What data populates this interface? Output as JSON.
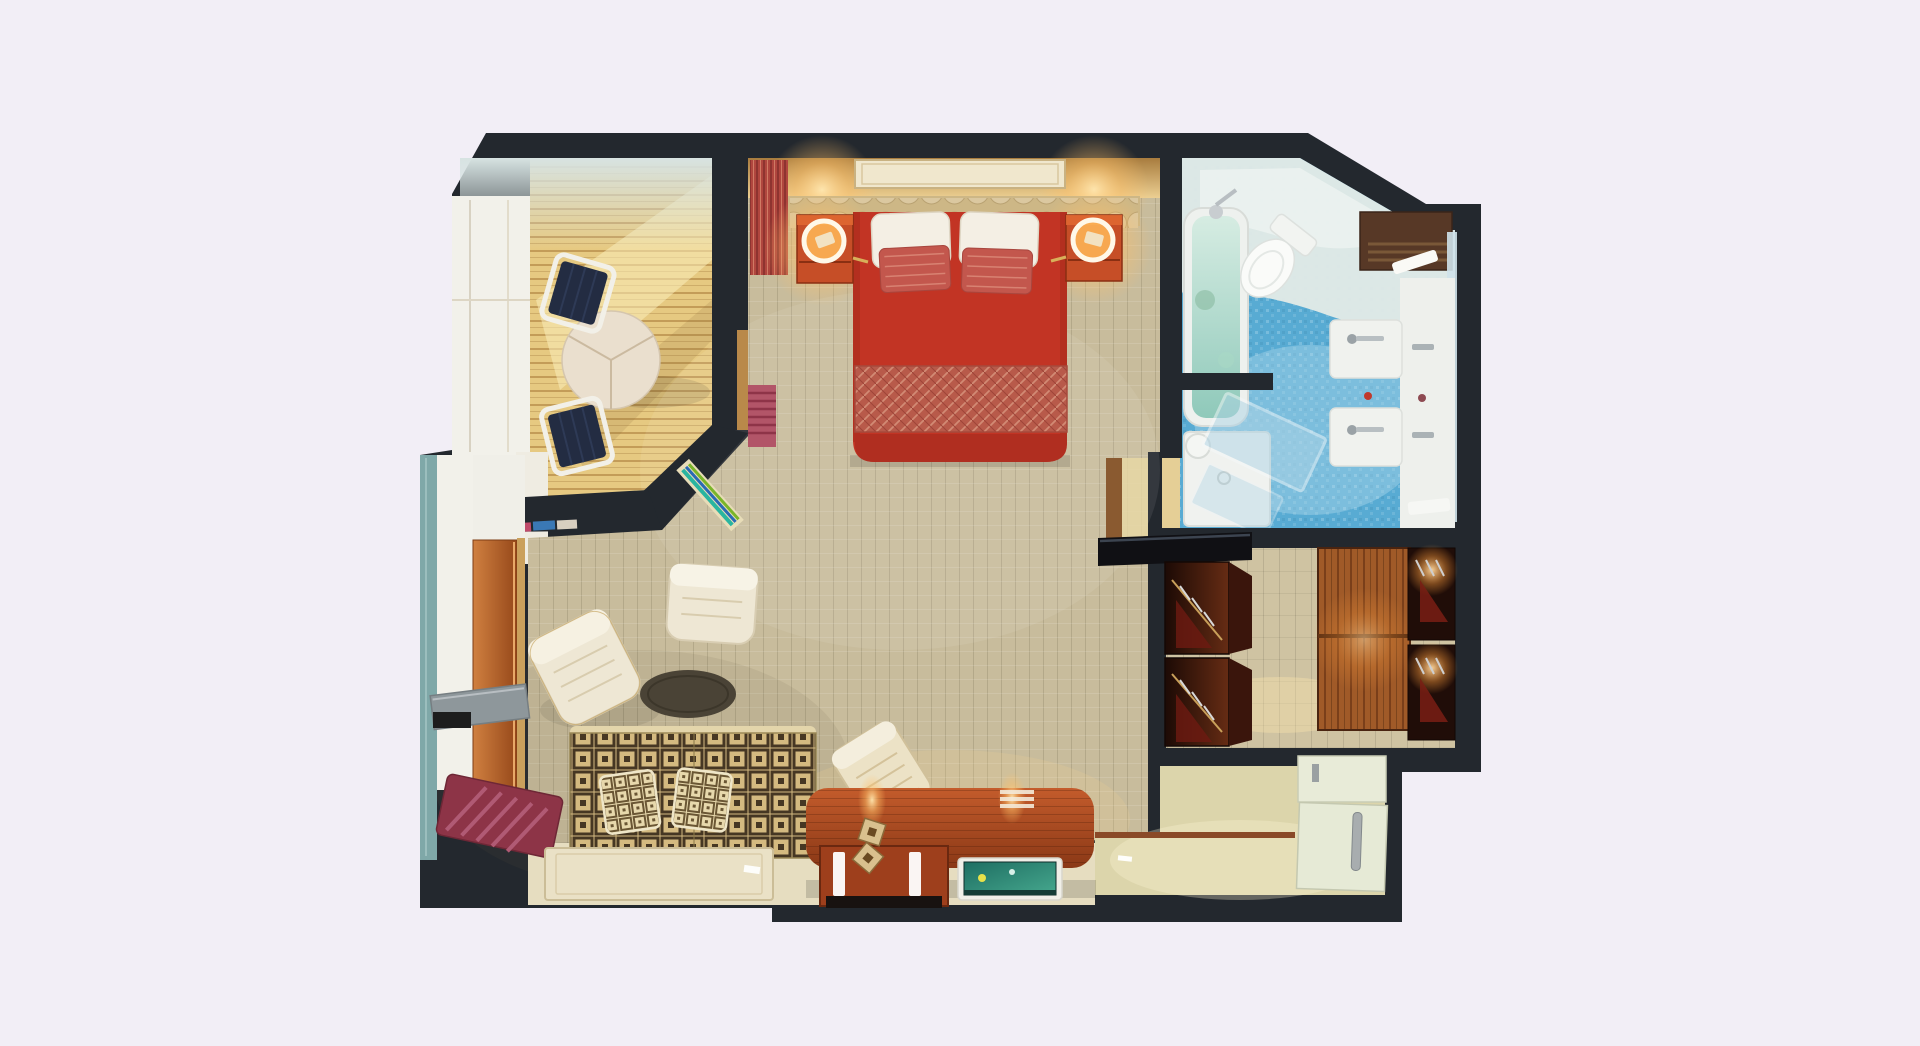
{
  "image_kind": "3d-floor-plan-render-top-down",
  "palette": {
    "background": "#f2eef6",
    "wall": "#23282e",
    "wallLight": "#f2f1ea",
    "carpet": "#c8bc9c",
    "woodFloor": "#e6c981",
    "paleFloor": "#e6ddc0",
    "entryFloor": "#dcd5ab",
    "closetFloor": "#cfc3a2",
    "bathFloorBlue": "#58abd3",
    "mintSweep": "#e0e9e6",
    "bedRed": "#c23424",
    "bedFoot": "#b02e20",
    "pillowWhite": "#f4efe4",
    "pillowRed": "#c3574d",
    "nightstand": "#c64e27",
    "headboard": "#cdb786",
    "tableCream": "#eadfce",
    "chairNavy": "#232c42",
    "chairFrame": "#f2f0e8",
    "rugOlive": "#4a4336",
    "armchairCream": "#eee7d4",
    "sofaBase": "#d4ba80",
    "benchMaroon": "#8d3447",
    "shelfGrey": "#8e979b",
    "glassTeal": "#7fa8a8",
    "toiletWhite": "#fafbf9",
    "vanityWhite": "#eef0ec",
    "tubWhite": "#eef1ee",
    "woodShelf": "#573826",
    "thresholdWood": "#8a4a28",
    "entryDoor": "#e8ebd8",
    "glowWarm": "#ffd98c"
  },
  "scene": {
    "rooms": [
      {
        "id": "balcony-dining-nook",
        "furniture": [
          "round-dining-table",
          "dining-chair",
          "dining-chair",
          "window-wall"
        ]
      },
      {
        "id": "bedroom",
        "furniture": [
          "double-bed",
          "white-pillow",
          "white-pillow",
          "red-pillow",
          "red-pillow",
          "patterned-blanket",
          "headboard",
          "ceiling-vent",
          "nightstand",
          "nightstand",
          "ring-lamp",
          "ring-lamp",
          "red-curtain",
          "red-blind"
        ]
      },
      {
        "id": "bathroom",
        "furniture": [
          "bathtub",
          "tub-faucet",
          "toilet",
          "double-sink-vanity",
          "sink-faucet",
          "sink-faucet",
          "shower-tray",
          "shower-glass-door",
          "mirror-strip",
          "wood-towel-shelf",
          "towel"
        ]
      },
      {
        "id": "walk-in-closet",
        "furniture": [
          "wardrobe-open",
          "wardrobe-open",
          "sliding-wood-doors",
          "wardrobe-spotlit",
          "wardrobe-spotlit",
          "gloss-counter"
        ]
      },
      {
        "id": "entry-hall",
        "furniture": [
          "entry-door",
          "door-long-handle",
          "upper-door-panel",
          "wood-threshold"
        ]
      },
      {
        "id": "living-area",
        "furniture": [
          "patterned-sofa",
          "sofa-cushion",
          "sofa-cushion",
          "armchair",
          "armchair",
          "oval-rug",
          "floor-mat",
          "remote-control",
          "desk-console",
          "desk-chair",
          "flat-tv",
          "led-strip",
          "led-strip",
          "decor-dice",
          "wood-entry-door-leaf",
          "coat-shelf",
          "maroon-bench",
          "glass-panel"
        ]
      }
    ]
  }
}
